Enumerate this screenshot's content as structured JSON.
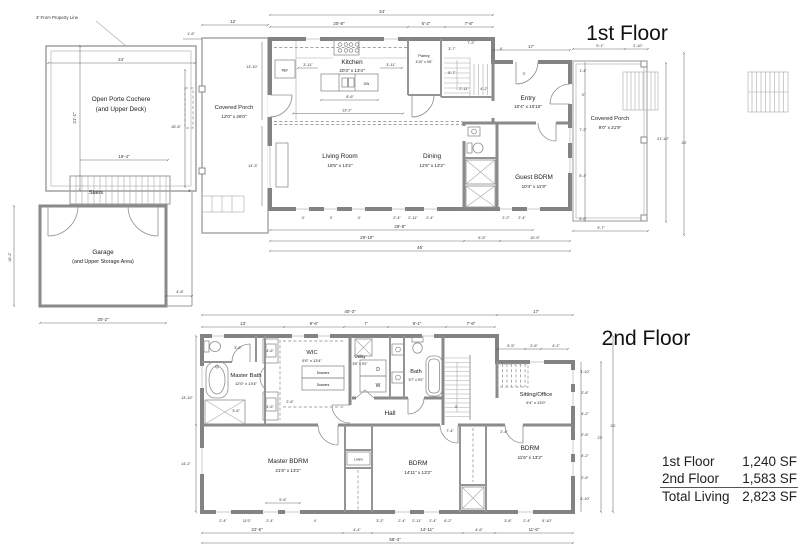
{
  "titles": {
    "floor1": "1st Floor",
    "floor2": "2nd Floor"
  },
  "area_table": {
    "rows": [
      {
        "label": "1st Floor",
        "value": "1,240 SF"
      },
      {
        "label": "2nd Floor",
        "value": "1,583 SF"
      },
      {
        "label": "Total Living",
        "value": "2,823 SF"
      }
    ]
  },
  "floor1": {
    "annotation": "3' From Property Line",
    "rooms": {
      "porte_cochere": {
        "name": "Open Porte Cochere",
        "name2": "(and Upper Deck)"
      },
      "stairs": {
        "name": "Stairs"
      },
      "garage": {
        "name": "Garage",
        "name2": "(and Upper Storage Area)"
      },
      "covered_porch_left": {
        "name": "Covered Porch",
        "size": "12'0\" x 26'0\""
      },
      "kitchen": {
        "name": "Kitchen",
        "size": "20'3\" x 13'4\""
      },
      "pantry": {
        "name": "Pantry",
        "size": "4'10\" x 4'6\""
      },
      "entry": {
        "name": "Entry",
        "size": "10'4\" x 10'10\""
      },
      "living": {
        "name": "Living Room",
        "size": "18'5\" x 13'2\""
      },
      "dining": {
        "name": "Dining",
        "size": "12'6\" x 13'2\""
      },
      "guest": {
        "name": "Guest BDRM",
        "size": "10'4\" x 11'9\""
      },
      "covered_porch_right": {
        "name": "Covered Porch",
        "size": "9'0\" x 21'9\""
      }
    },
    "fixtures": {
      "ref": "REF",
      "dw": "DW"
    },
    "dims": {
      "d34": "34'",
      "d20_8": "20'-8\"",
      "d6_2": "6'-2\"",
      "d7_8": "7'-8\"",
      "d12": "12'",
      "d1_6": "1'-6\"",
      "d24": "24'",
      "d21_1": "21'-1\"",
      "d19_4": "19'-4\"",
      "d26_6": "26'-6\"",
      "d4": "4'",
      "d13_10": "13'-10\"",
      "d14_3": "14'-3\"",
      "d16_2": "16'-2\"",
      "d20_2": "20'-2\"",
      "d4_8": "4'-8\"",
      "d3_11": "3'-11\"",
      "d8_6": "8'-6\"",
      "d13_2": "13'-2\"",
      "d3_7": "3'-7\"",
      "d7_2": "7'-2\"",
      "d5_7": "5'-7\"",
      "d2_11": "2'-11\"",
      "d4_2": "4'-2\"",
      "d17": "17'",
      "d3": "3'",
      "d9_1": "9'-1\"",
      "d2_10": "2'-10\"",
      "d1_4": "1'-4\"",
      "d5_4": "5'-4\"",
      "d4_0": "4'-0\"",
      "d21_10": "21'-10\"",
      "d9_7": "9'-7\"",
      "d2_4": "2'-4\"",
      "d2_2": "2'-2\"",
      "d29_8": "29'-8\"",
      "d29_10": "29'-10\"",
      "d5_5": "5'-5\"",
      "d10_9": "10'-9\"",
      "d46": "46'"
    }
  },
  "floor2": {
    "rooms": {
      "master_bath": {
        "name": "Master Bath",
        "size": "12'0\" x 13'4\""
      },
      "wic": {
        "name": "WIC",
        "size": "9'0\" x 13'4\""
      },
      "utility": {
        "name": "Utility",
        "size": "5'5\" x 9'0\""
      },
      "bath": {
        "name": "Bath",
        "size": "5'7\" x 9'0\""
      },
      "hall": {
        "name": "Hall"
      },
      "sitting": {
        "name": "Sitting/Office",
        "size": "9'4\" x 13'0\""
      },
      "master_bdrm": {
        "name": "Master BDRM",
        "size": "21'6\" x 13'2\""
      },
      "bdrm2": {
        "name": "BDRM",
        "size": "14'11\" x 13'2\""
      },
      "bdrm3": {
        "name": "BDRM",
        "size": "11'6\" x 13'2\""
      },
      "linen": {
        "name": "Linen"
      }
    },
    "labels": {
      "dryer": "D",
      "washer": "W",
      "drawers": "Drawers"
    },
    "dims": {
      "d40_3": "40'-3\"",
      "d17": "17'",
      "d13": "13'",
      "d9_6": "9'-6\"",
      "d7": "7'",
      "d9_1": "9'-1\"",
      "d7_8": "7'-8\"",
      "d5_5": "5'-5\"",
      "d2_6": "2'-6\"",
      "d4_2": "4'-2\"",
      "d3_10": "3'-10\"",
      "d23": "23'",
      "d24": "24'",
      "d13_10": "13'-10\"",
      "d14_2": "14'-2\"",
      "d3_6": "3'-6\"",
      "d4_6": "4'-6\"",
      "d3": "3'",
      "d7_4": "7'-4\"",
      "d5_6": "5'-6\"",
      "d2_4": "2'-4\"",
      "d11_0": "11'0\"",
      "d4": "4'",
      "d3_2": "3'-2\"",
      "d2_11": "2'-11\"",
      "d6_2": "6'-2\"",
      "d3_8": "3'-8\"",
      "d5_10": "5'-10\"",
      "d22_6": "22'-6\"",
      "d4_4": "4'-4\"",
      "d14_11": "14'-11\"",
      "d11_6": "11'-6\"",
      "d58_3": "58'-3\""
    }
  }
}
